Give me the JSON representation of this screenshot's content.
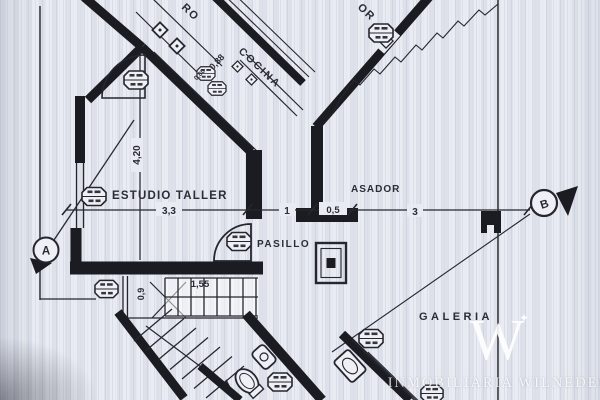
{
  "colors": {
    "paper": "#e8ebf1",
    "ink": "#26262e",
    "wall": "#1b1b22",
    "watermark": "#ffffff"
  },
  "rooms": {
    "estudio_taller": "ESTUDIO TALLER",
    "cocina": "COCINA",
    "asador": "ASADOR",
    "pasillo": "PASILLO",
    "galeria": "GALERIA"
  },
  "fragments": {
    "top_left": "RO",
    "top_right": "OR"
  },
  "dimensions": {
    "d420": "4,20",
    "d33": "3,3",
    "d1": "1",
    "d05": "0,5",
    "d3": "3",
    "d088": "0,88",
    "d080": "0,80",
    "d09": "0,9",
    "d155": "1,55"
  },
  "markers": {
    "a": "A",
    "b": "B"
  },
  "watermark": {
    "logo": "W",
    "star": "✦",
    "brand": "INMOBILIARIA WILNEDER"
  }
}
